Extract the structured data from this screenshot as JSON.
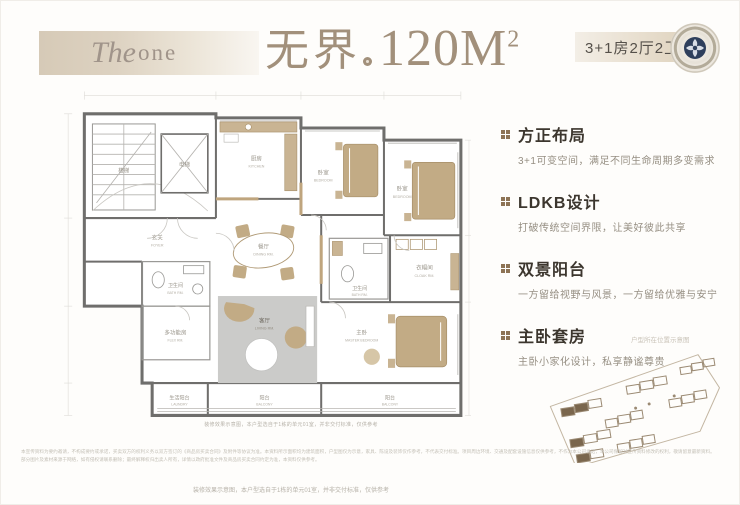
{
  "header": {
    "logo_script": "The",
    "logo_rest": "one",
    "title_zh": "无界",
    "title_area": "120M",
    "title_area_sup": "2",
    "spec": "3+1房2厅2卫"
  },
  "features": [
    {
      "title": "方正布局",
      "desc": "3+1可变空间，满足不同生命周期多变需求"
    },
    {
      "title": "LDKB设计",
      "desc": "打破传统空间界限，让美好彼此共享"
    },
    {
      "title": "双景阳台",
      "desc": "一方留给视野与风景，一方留给优雅与安宁"
    },
    {
      "title": "主卧套房",
      "desc": "主卧小家化设计，私享静谧尊贵"
    }
  ],
  "floorplan": {
    "caption": "装修效果示意图，本户型选自于1栋的单元01室，并非交付标准，仅供参考",
    "rooms": [
      {
        "label": "楼梯",
        "en": ""
      },
      {
        "label": "电梯",
        "en": ""
      },
      {
        "label": "厨房",
        "en": "KITCHEN"
      },
      {
        "label": "卧室",
        "en": "BEDROOM"
      },
      {
        "label": "卧室",
        "en": "BEDROOM"
      },
      {
        "label": "玄关",
        "en": "FOYER"
      },
      {
        "label": "卫生间",
        "en": "BATH RM."
      },
      {
        "label": "餐厅",
        "en": "DINING RM."
      },
      {
        "label": "卫生间",
        "en": "BATH RM."
      },
      {
        "label": "衣帽间",
        "en": "CLOAK RM."
      },
      {
        "label": "客厅",
        "en": "LIVING RM."
      },
      {
        "label": "多功能房",
        "en": "FLEX RM."
      },
      {
        "label": "主卧",
        "en": "MASTER BEDROOM"
      },
      {
        "label": "生活阳台",
        "en": "LAUNDRY"
      },
      {
        "label": "阳台",
        "en": "BALCONY"
      },
      {
        "label": "阳台",
        "en": "BALCONY"
      }
    ]
  },
  "siteplan": {
    "caption": "户型所在位置示意图"
  },
  "footer": {
    "legal_line1": "本宣传资料为要约邀请，不构成要约或承诺，买卖双方的权利义务以双方签订的《商品房买卖合同》及附件等协议为准。本资料所示面积均为建筑面积，户型图仅为示意，家具、陈设及装饰仅作参考，不代表交付标准。项目周边环境、交通及配套设施信息仅供参考，不作为本公司承诺，本公司保留对宣传资料修改的权利，敬请留意最新资料。",
    "legal_line2": "部分图片及素材来源于网络，如有侵权请联系删除；最终解释权归出卖人所有，详情以政府批准文件及商品房买卖合同约定为准，本资料仅供参考。",
    "note": "装修效果示意图，本户型选自于1栋的单元01室，并非交付标准，仅供参考"
  },
  "colors": {
    "banner_tan": "#d6cab7",
    "title_brown": "#a2907b",
    "bullet_brown": "#8d7355",
    "emblem_navy": "#2e3f5c",
    "plan_wall": "#6f6e6c",
    "plan_furniture": "#bda683",
    "plan_rug": "#cbcbc9"
  }
}
